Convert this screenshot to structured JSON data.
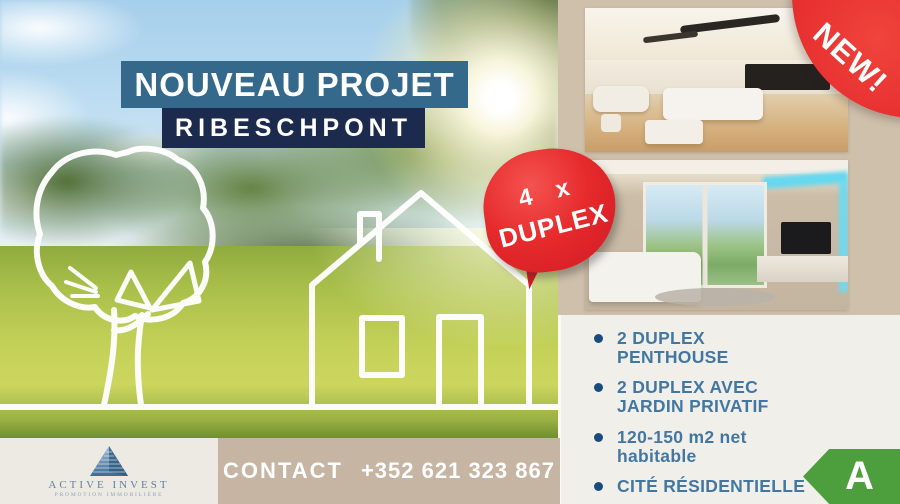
{
  "header": {
    "title_line1": "NOUVEAU PROJET",
    "title_line2": "RIBESCHPONT"
  },
  "duplex_badge": {
    "line1": "4 x",
    "line2": "DUPLEX"
  },
  "new_badge": {
    "label": "NEW!"
  },
  "features": [
    {
      "lines": [
        "2 DUPLEX",
        "PENTHOUSE"
      ]
    },
    {
      "lines": [
        "2 DUPLEX AVEC",
        "JARDIN PRIVATIF"
      ]
    },
    {
      "lines": [
        "120-150 m2 net",
        "habitable"
      ]
    },
    {
      "lines": [
        "CITÉ RÉSIDENTIELLE"
      ]
    }
  ],
  "contact_bar": {
    "label": "CONTACT",
    "phone": "+352 621 323 867"
  },
  "energy_badge": {
    "rating": "A",
    "color": "#4C9F3C"
  },
  "logo": {
    "company": "ACTIVE INVEST",
    "tagline": "PROMOTION IMMOBILIÈRE"
  },
  "colors": {
    "title_bg": "#35698C",
    "subtitle_bg": "#1C2B4D",
    "accent_red": "#E2262C",
    "feature_text": "#4377A2",
    "bullet_dot": "#1A4B7E",
    "contact_bg": "#C5B5A2",
    "right_column_bg": "#CFC0AC",
    "panel_bg": "#F1EFE9",
    "logo_bg": "#EDEAE3"
  }
}
